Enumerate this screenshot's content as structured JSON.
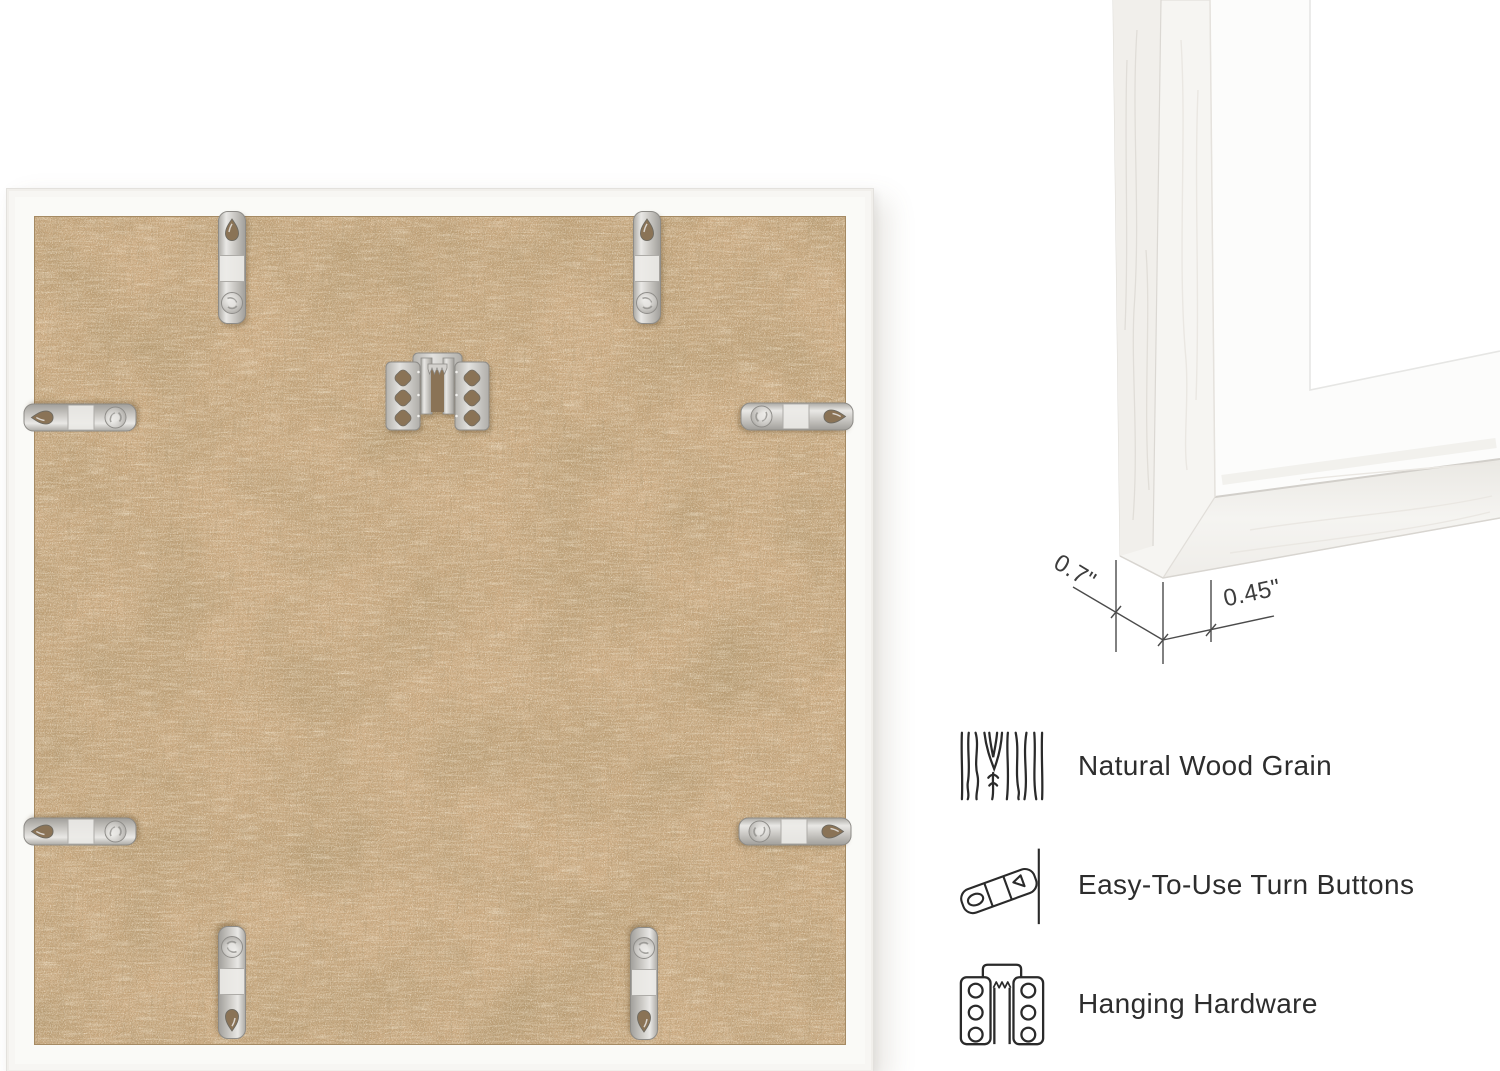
{
  "dimensions": {
    "depth_label": "0.7\"",
    "face_label": "0.45\""
  },
  "features": [
    {
      "icon": "wood-grain-icon",
      "label": "Natural Wood Grain"
    },
    {
      "icon": "turn-button-icon",
      "label": "Easy-To-Use Turn Buttons"
    },
    {
      "icon": "hanging-hardware-icon",
      "label": "Hanging Hardware"
    }
  ],
  "frame_back": {
    "backing_board": "mdf-backing-board",
    "hanger": "sawtooth-hanger",
    "turn_button_count": 8
  },
  "colors": {
    "background": "#ffffff",
    "mdf_board": "#cdab82",
    "frame_white": "#fafaf7",
    "metal": "#d6d4d0",
    "text": "#2d2d2d",
    "dimension_lines": "#4b4b4b"
  }
}
